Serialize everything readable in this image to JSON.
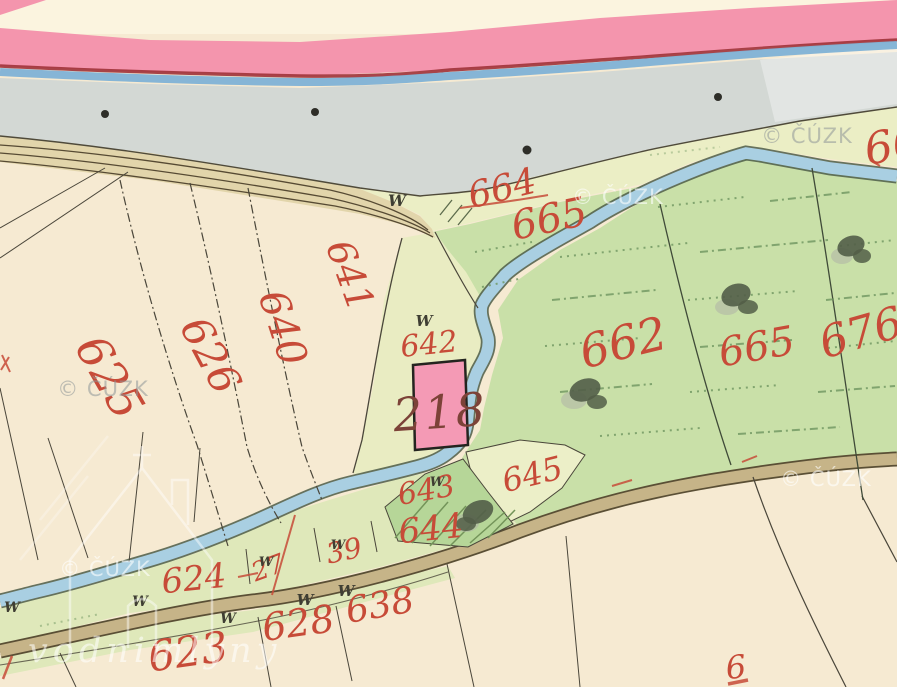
{
  "map": {
    "description": "scanned historical cadastral map sheet",
    "watermarks": {
      "cuzk": "© ČÚZK",
      "mills": "vodnimlyny"
    },
    "symbols": {
      "meadow": "W"
    },
    "labels": {
      "p625": "625",
      "p626": "626",
      "p640": "640",
      "p641": "641",
      "p642": "642",
      "p643": "643",
      "p644": "644",
      "p645": "645",
      "p664": "664",
      "p665a": "665",
      "p662": "662",
      "p665b": "665",
      "p676": "676",
      "p624": "624",
      "p623": "623",
      "p628": "628",
      "p638": "638",
      "p27": "27",
      "p39": "39",
      "road": "1334",
      "house": "218",
      "edge_right": "66",
      "edge_bottom": "6"
    },
    "colors": {
      "paper": "#f6ead2",
      "paper_light": "#fbf4df",
      "pink_band": "#f495ad",
      "carmine": "#a03238",
      "water_gray": "#d3d8d4",
      "blue_line": "#7fb2d6",
      "stream": "#a9cfe2",
      "stream_edge": "#4c5c48",
      "meadow": "#c9e0a8",
      "meadow_dark": "#b6d698",
      "pale_strip": "#ebeec5",
      "strip_green": "#dfe8ba",
      "road_tan": "#c6b488",
      "road_edge": "#5a4f35",
      "label_red": "#c74b38",
      "house_pink": "#f49ab5",
      "house_number": "#7c4238",
      "ink": "#4a463a"
    }
  }
}
